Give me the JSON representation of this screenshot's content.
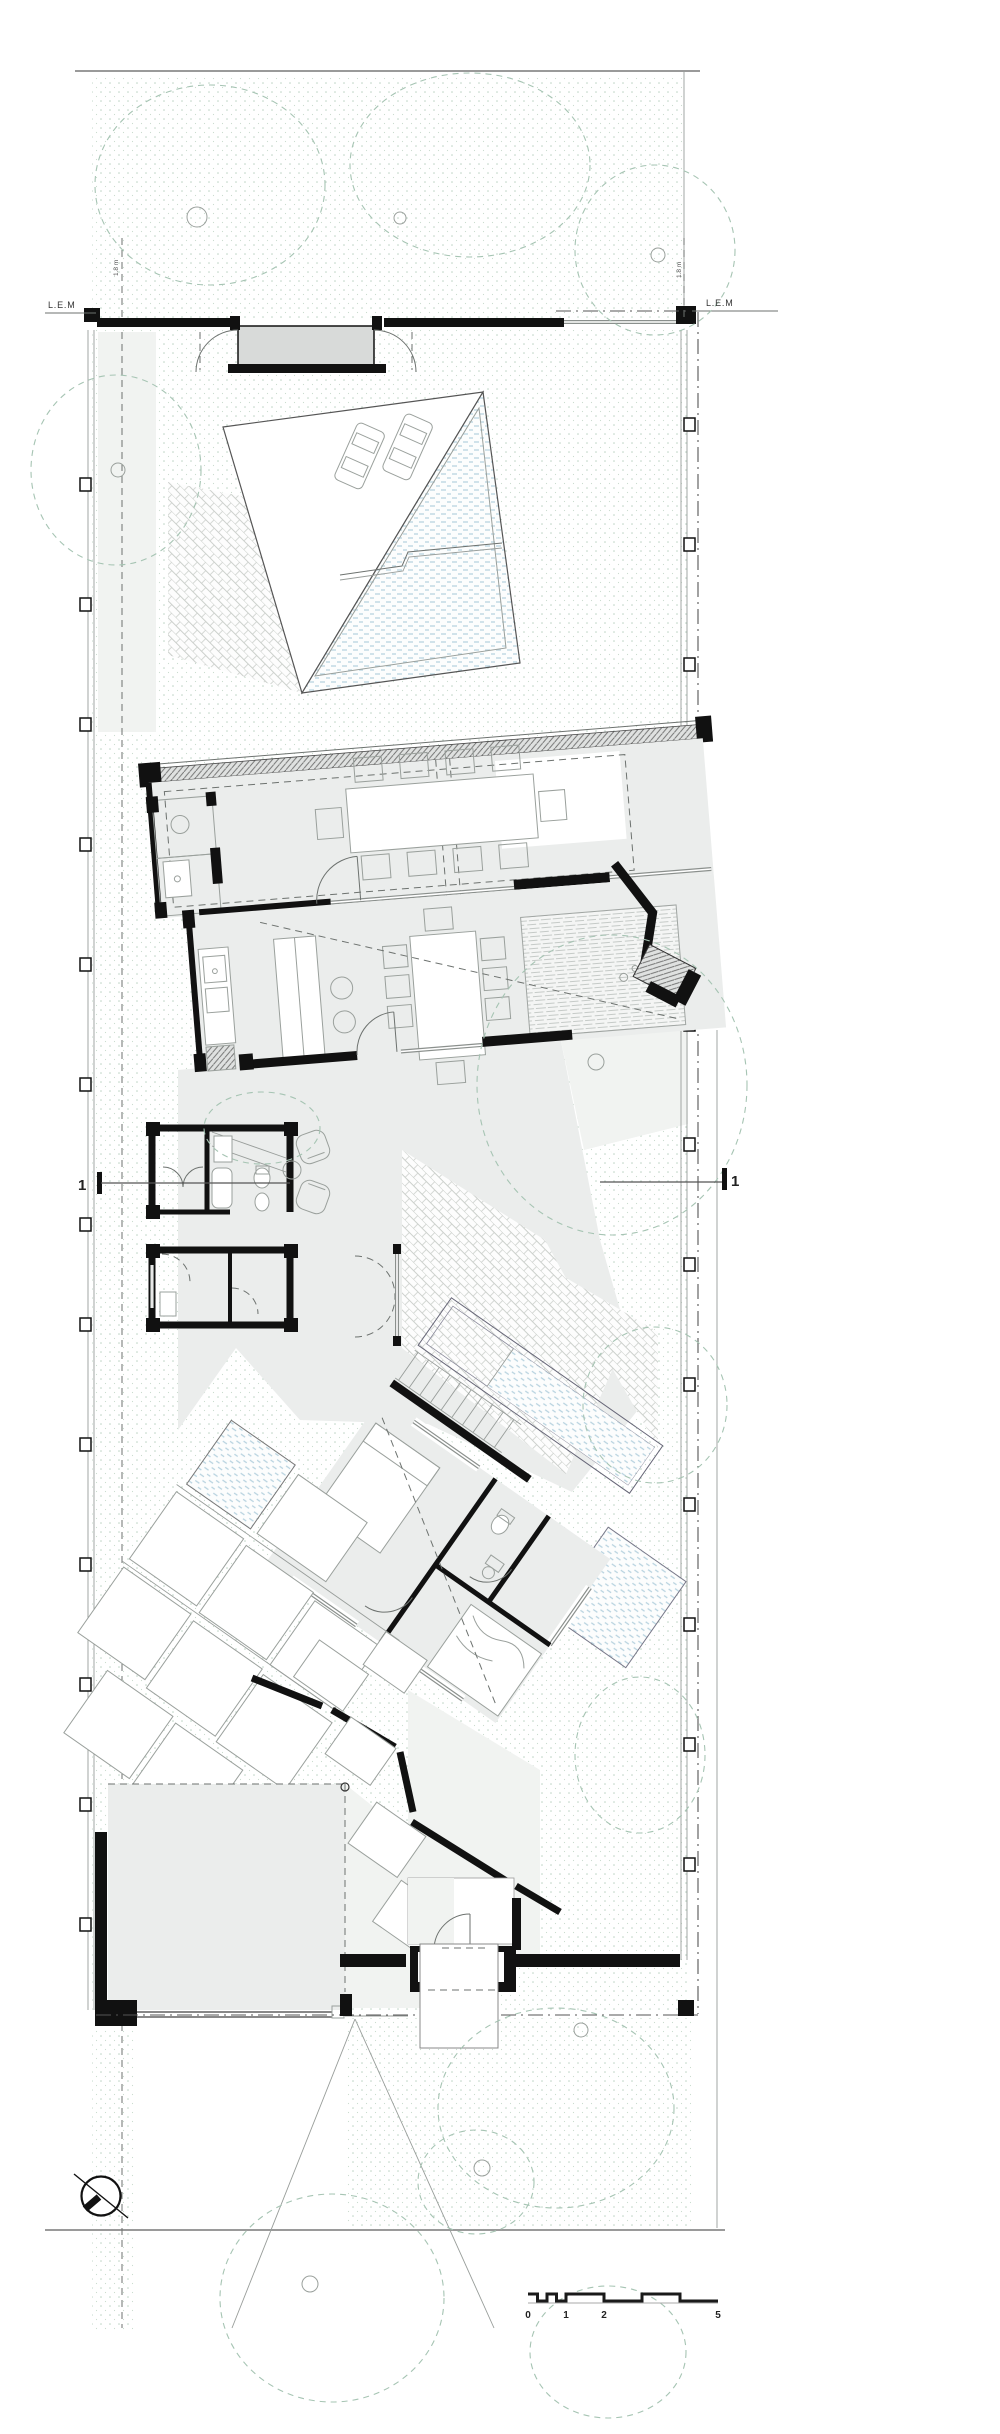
{
  "boundary": {
    "lem_left": "L.E.M",
    "lem_right": "L.E.M",
    "setback_left": "1.8 m",
    "setback_right": "1.8 m"
  },
  "section_markers": {
    "left": "1",
    "right": "1"
  },
  "scale_bar": {
    "labels": [
      "0",
      "1",
      "2",
      "5"
    ]
  },
  "icons": [
    "north-arrow-icon",
    "tree-canopy",
    "car-icon",
    "scale-bar",
    "section-cut-marker"
  ],
  "colors": {
    "wall": "#111111",
    "thin_line": "#6d726f",
    "tree_dash": "#a6c4b3",
    "ground_dot": "#bcd2c4",
    "floor": "#ebedec",
    "floor_light": "#f1f3f1",
    "water_hatch": "#b7d2df",
    "paving": "#ccd0cc",
    "street_line": "#9a9a9a"
  }
}
